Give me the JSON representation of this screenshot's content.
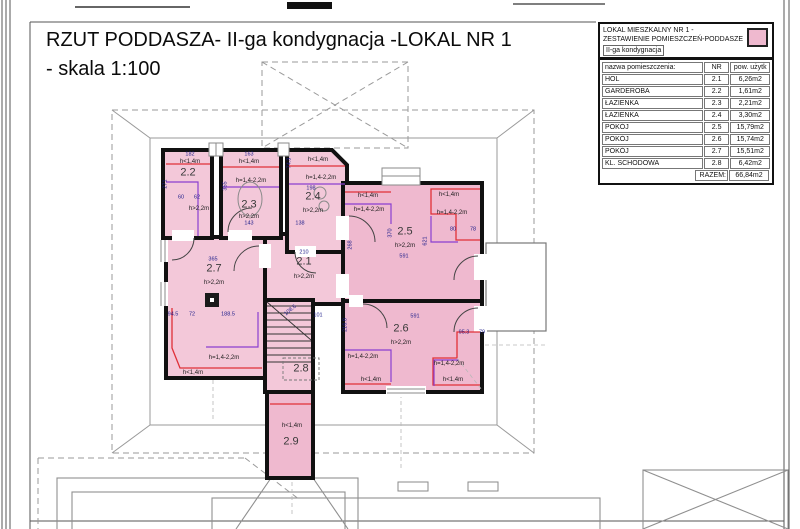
{
  "title": {
    "line1": "RZUT PODDASZA- II-ga kondygnacja -LOKAL NR 1",
    "line2": "-  skala 1:100"
  },
  "legend": {
    "header_line1": "LOKAL MIESZKALNY NR 1 -",
    "header_line2": "ZESTAWIENIE POMIESZCZEŃ-PODDASZE",
    "header_line3": "II-ga kondygnacja",
    "col_name": "nazwa pomieszczenia:",
    "col_nr": "NR",
    "col_area": "pow. użytk",
    "rows": [
      {
        "name": "HOL",
        "nr": "2.1",
        "area": "6,26m2"
      },
      {
        "name": "GARDEROBA",
        "nr": "2.2",
        "area": "1,61m2"
      },
      {
        "name": "ŁAZIENKA",
        "nr": "2.3",
        "area": "2,21m2"
      },
      {
        "name": "ŁAZIENKA",
        "nr": "2.4",
        "area": "3,30m2"
      },
      {
        "name": "POKÓJ",
        "nr": "2.5",
        "area": "15,79m2"
      },
      {
        "name": "POKÓJ",
        "nr": "2.6",
        "area": "15,74m2"
      },
      {
        "name": "POKÓJ",
        "nr": "2.7",
        "area": "15,51m2"
      },
      {
        "name": "KL. SCHODOWA",
        "nr": "2.8",
        "area": "6,42m2"
      }
    ],
    "total_label": "RAZEM:",
    "total_value": "66,84m2"
  },
  "colors": {
    "room-fill": "#f3c8d9",
    "room-fill-strong": "#efb9cf",
    "wall": "#111111",
    "zone-red": "#e03038",
    "zone-purple": "#8a3fd0",
    "dim-navy": "#1c1c8a",
    "roof-gray": "#9a9a9a"
  },
  "plan_labels": [
    {
      "t": "2.1",
      "x": 304,
      "y": 262,
      "cls": "room-num",
      "n": "room-number-2-1"
    },
    {
      "t": "2.2",
      "x": 188,
      "y": 173,
      "cls": "room-num",
      "n": "room-number-2-2"
    },
    {
      "t": "2.3",
      "x": 249,
      "y": 205,
      "cls": "room-num",
      "n": "room-number-2-3"
    },
    {
      "t": "2.4",
      "x": 313,
      "y": 197,
      "cls": "room-num",
      "n": "room-number-2-4"
    },
    {
      "t": "2.5",
      "x": 405,
      "y": 232,
      "cls": "room-num",
      "n": "room-number-2-5"
    },
    {
      "t": "2.6",
      "x": 401,
      "y": 329,
      "cls": "room-num",
      "n": "room-number-2-6"
    },
    {
      "t": "2.7",
      "x": 214,
      "y": 269,
      "cls": "room-num",
      "n": "room-number-2-7"
    },
    {
      "t": "2.8",
      "x": 301,
      "y": 369,
      "cls": "room-num",
      "n": "room-number-2-8"
    },
    {
      "t": "2.9",
      "x": 291,
      "y": 442,
      "cls": "room-num",
      "n": "room-number-2-9"
    },
    {
      "t": "h>2,2m",
      "x": 304,
      "y": 277,
      "cls": "h-label",
      "n": "height-label"
    },
    {
      "t": "h>2,2m",
      "x": 199,
      "y": 209,
      "cls": "h-label",
      "n": "height-label"
    },
    {
      "t": "h>2,2m",
      "x": 249,
      "y": 217,
      "cls": "h-label",
      "n": "height-label"
    },
    {
      "t": "h>2,2m",
      "x": 313,
      "y": 211,
      "cls": "h-label",
      "n": "height-label"
    },
    {
      "t": "h>2,2m",
      "x": 405,
      "y": 246,
      "cls": "h-label",
      "n": "height-label"
    },
    {
      "t": "h>2,2m",
      "x": 401,
      "y": 343,
      "cls": "h-label",
      "n": "height-label"
    },
    {
      "t": "h>2,2m",
      "x": 214,
      "y": 283,
      "cls": "h-label",
      "n": "height-label"
    },
    {
      "t": "h<1,4m",
      "x": 190,
      "y": 162,
      "cls": "h-label",
      "n": "height-label"
    },
    {
      "t": "h<1,4m",
      "x": 249,
      "y": 162,
      "cls": "h-label",
      "n": "height-label"
    },
    {
      "t": "h<1,4m",
      "x": 318,
      "y": 160,
      "cls": "h-label",
      "n": "height-label"
    },
    {
      "t": "h<1,4m",
      "x": 368,
      "y": 196,
      "cls": "h-label",
      "n": "height-label"
    },
    {
      "t": "h<1,4m",
      "x": 449,
      "y": 195,
      "cls": "h-label",
      "n": "height-label"
    },
    {
      "t": "h<1,4m",
      "x": 193,
      "y": 373,
      "cls": "h-label",
      "n": "height-label"
    },
    {
      "t": "h<1,4m",
      "x": 371,
      "y": 380,
      "cls": "h-label",
      "n": "height-label"
    },
    {
      "t": "h<1,4m",
      "x": 453,
      "y": 380,
      "cls": "h-label",
      "n": "height-label"
    },
    {
      "t": "h<1,4m",
      "x": 292,
      "y": 426,
      "cls": "h-label",
      "n": "height-label"
    },
    {
      "t": "h=1,4-2,2m",
      "x": 251,
      "y": 181,
      "cls": "h-label",
      "n": "height-label"
    },
    {
      "t": "h=1,4-2,2m",
      "x": 321,
      "y": 178,
      "cls": "h-label",
      "n": "height-label"
    },
    {
      "t": "h=1,4-2,2m",
      "x": 369,
      "y": 210,
      "cls": "h-label",
      "n": "height-label"
    },
    {
      "t": "h=1,4-2,2m",
      "x": 452,
      "y": 213,
      "cls": "h-label",
      "n": "height-label"
    },
    {
      "t": "h=1,4-2,2m",
      "x": 363,
      "y": 357,
      "cls": "h-label",
      "n": "height-label"
    },
    {
      "t": "h=1,4-2,2m",
      "x": 449,
      "y": 364,
      "cls": "h-label",
      "n": "height-label"
    },
    {
      "t": "h=1,4-2,2m",
      "x": 224,
      "y": 358,
      "cls": "h-label",
      "n": "height-label"
    },
    {
      "t": "182",
      "x": 190,
      "y": 155,
      "cls": "dim",
      "n": "dim-label"
    },
    {
      "t": "163",
      "x": 249,
      "y": 155,
      "cls": "dim",
      "n": "dim-label"
    },
    {
      "t": "198",
      "x": 311,
      "y": 189,
      "cls": "dim",
      "n": "dim-label"
    },
    {
      "t": "138",
      "x": 300,
      "y": 224,
      "cls": "dim",
      "n": "dim-label"
    },
    {
      "t": "143",
      "x": 249,
      "y": 224,
      "cls": "dim",
      "n": "dim-label"
    },
    {
      "t": "60",
      "x": 181,
      "y": 198,
      "cls": "dim",
      "n": "dim-label"
    },
    {
      "t": "62",
      "x": 197,
      "y": 198,
      "cls": "dim",
      "n": "dim-label"
    },
    {
      "t": "365",
      "x": 213,
      "y": 260,
      "cls": "dim",
      "n": "dim-label"
    },
    {
      "t": "210",
      "x": 304,
      "y": 253,
      "cls": "dim",
      "n": "dim-label"
    },
    {
      "t": "94.5",
      "x": 173,
      "y": 315,
      "cls": "dim",
      "n": "dim-label"
    },
    {
      "t": "72",
      "x": 192,
      "y": 315,
      "cls": "dim",
      "n": "dim-label"
    },
    {
      "t": "188.5",
      "x": 228,
      "y": 315,
      "cls": "dim",
      "n": "dim-label"
    },
    {
      "t": "101",
      "x": 318,
      "y": 316,
      "cls": "dim",
      "n": "dim-label"
    },
    {
      "t": "591",
      "x": 404,
      "y": 257,
      "cls": "dim",
      "n": "dim-label"
    },
    {
      "t": "80",
      "x": 453,
      "y": 230,
      "cls": "dim",
      "n": "dim-label"
    },
    {
      "t": "78",
      "x": 473,
      "y": 230,
      "cls": "dim",
      "n": "dim-label"
    },
    {
      "t": "591",
      "x": 415,
      "y": 317,
      "cls": "dim",
      "n": "dim-label"
    },
    {
      "t": "95.3",
      "x": 464,
      "y": 333,
      "cls": "dim",
      "n": "dim-label"
    },
    {
      "t": "79",
      "x": 482,
      "y": 333,
      "cls": "dim",
      "n": "dim-label"
    },
    {
      "t": "271",
      "x": 166,
      "y": 184,
      "cls": "dim",
      "r": -90,
      "n": "dim-label"
    },
    {
      "t": "355",
      "x": 226,
      "y": 186,
      "cls": "dim",
      "r": -90,
      "n": "dim-label"
    },
    {
      "t": "74.3",
      "x": 290,
      "y": 163,
      "cls": "dim",
      "r": -90,
      "n": "dim-label"
    },
    {
      "t": "268",
      "x": 351,
      "y": 245,
      "cls": "dim",
      "r": -90,
      "n": "dim-label"
    },
    {
      "t": "370",
      "x": 391,
      "y": 233,
      "cls": "dim",
      "r": -90,
      "n": "dim-label"
    },
    {
      "t": "621",
      "x": 426,
      "y": 241,
      "cls": "dim",
      "r": -90,
      "n": "dim-label"
    },
    {
      "t": "216.8",
      "x": 346,
      "y": 325,
      "cls": "dim",
      "r": -90,
      "n": "dim-label"
    },
    {
      "t": "108.6",
      "x": 291,
      "y": 311,
      "cls": "dim",
      "r": -40,
      "n": "dim-label"
    }
  ]
}
